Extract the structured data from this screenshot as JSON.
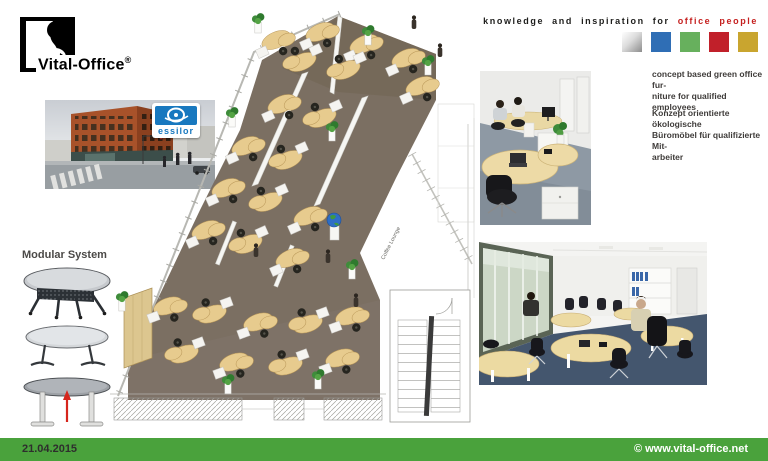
{
  "brand": {
    "name": "Vital-Office",
    "reg": "®"
  },
  "tagline": {
    "prefix": "knowledge and inspiration for",
    "highlight": "office people"
  },
  "swatches": {
    "names": [
      "silver",
      "blue",
      "green",
      "red",
      "gold"
    ],
    "styles": [
      "background:linear-gradient(135deg,#ffffff 0%,#dcdcdc 45%,#8c8c8c 100%)",
      "background:#2f6eb5",
      "background:#67b05d",
      "background:#c1202a",
      "background:#c9a52f"
    ]
  },
  "client_logo": {
    "text": "essilor"
  },
  "left_column": {
    "modular_label": "Modular System"
  },
  "captions": {
    "en": "concept based green office fur-\nniture for qualified employees",
    "de": "Konzept orientierte ökologische\nBüromöbel für qualifizierte Mit-\narbeiter"
  },
  "plan": {
    "coffee_lounge": "Coffee Lounge"
  },
  "footer": {
    "date": "21.04.2015",
    "copyright": "© www.vital-office.net"
  },
  "colors": {
    "footer_bar": "#4aa23c",
    "accent_red": "#c5201f",
    "floor": "#7b6f62",
    "desk": "#e7cb8e"
  }
}
